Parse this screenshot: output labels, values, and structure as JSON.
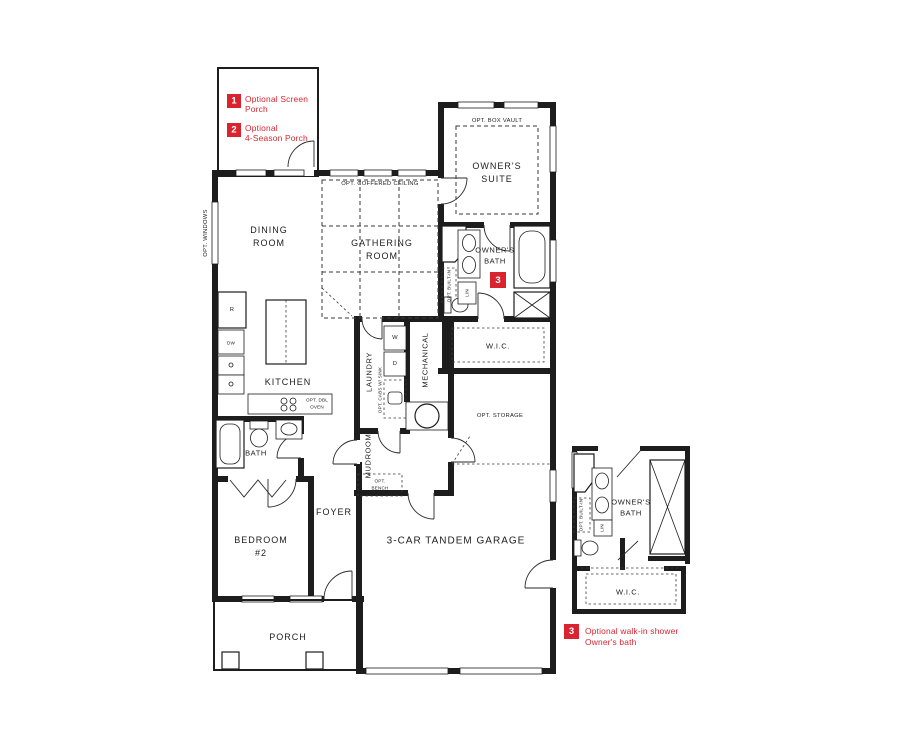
{
  "colors": {
    "wall": "#1d1d1d",
    "accent_red": "#d9242f",
    "background": "#ffffff"
  },
  "legend_top": {
    "items": [
      {
        "num": "1",
        "line1": "Optional Screen",
        "line2": "Porch"
      },
      {
        "num": "2",
        "line1": "Optional",
        "line2": "4-Season Porch"
      }
    ]
  },
  "legend_bottom": {
    "num": "3",
    "line1": "Optional walk-in shower",
    "line2": "Owner's bath"
  },
  "plan": {
    "owners_suite": {
      "note": "OPT. BOX VAULT",
      "line1": "OWNER'S",
      "line2": "SUITE"
    },
    "dining": {
      "line1": "DINING",
      "line2": "ROOM"
    },
    "opt_windows": "OPT. WINDOWS",
    "gathering": {
      "note": "OPT. COFFERED CEILING",
      "line1": "GATHERING",
      "line2": "ROOM"
    },
    "owners_bath": {
      "line1": "OWNER'S",
      "line2": "BATH",
      "badge": "3",
      "builtin": "OPT. BUILT-IN",
      "linen": "LIN"
    },
    "wic": "W.I.C.",
    "kitchen": {
      "label": "KITCHEN",
      "fridge": "R",
      "dishwasher": "DW",
      "oven1": "OPT. DBL",
      "oven2": "OVEN"
    },
    "laundry": {
      "label": "LAUNDRY",
      "washer": "W",
      "dryer": "D",
      "note": "OPT. CABS W/ SINK"
    },
    "mechanical": "MECHANICAL",
    "mudroom": {
      "label": "MUDROOM",
      "bench1": "OPT.",
      "bench2": "BENCH"
    },
    "bath2": "BATH",
    "bedroom2": {
      "line1": "BEDROOM",
      "line2": "#2"
    },
    "foyer": "FOYER",
    "garage": {
      "label": "3-CAR TANDEM GARAGE",
      "storage": "OPT. STORAGE"
    },
    "porch": "PORCH"
  },
  "inset": {
    "bath1": "OWNER'S",
    "bath2": "BATH",
    "builtin": "OPT. BUILT-IN",
    "linen": "LIN",
    "wic": "W.I.C."
  }
}
